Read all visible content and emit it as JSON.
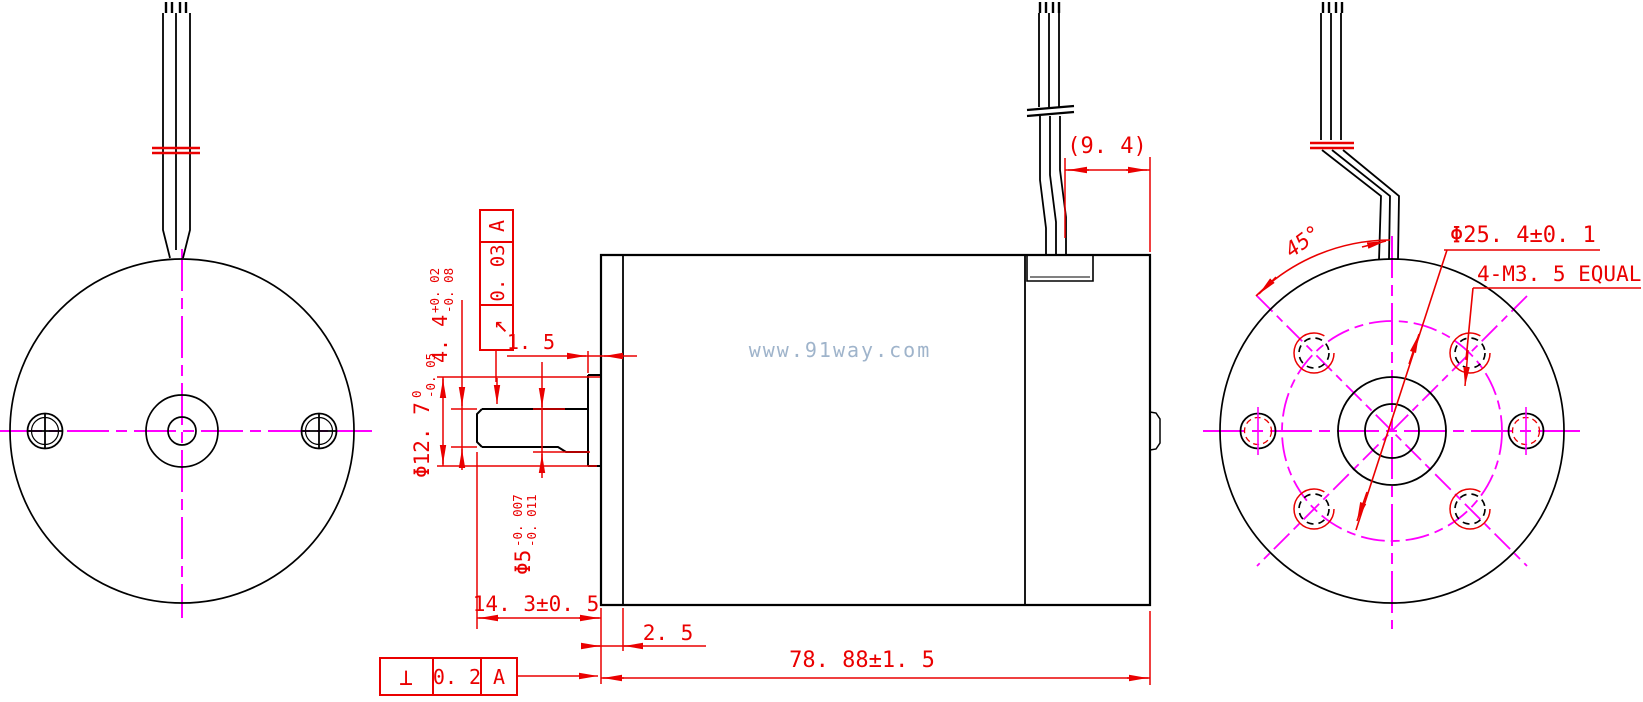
{
  "watermark": "www.91way.com",
  "colors": {
    "geometry": "#000000",
    "dimension": "#ea0000",
    "centerline": "#ff00ff",
    "watermark": "#8fa7c2"
  },
  "dimensions": {
    "wire_stub": "(9. 4)",
    "boss_protrusion": "1. 5",
    "shaft_flat": {
      "value": "4. 4",
      "upper": "+0. 02",
      "lower": "-0. 08"
    },
    "boss_diameter": {
      "value": "Φ12. 7",
      "upper": "0",
      "lower": "-0. 05"
    },
    "shaft_diameter": {
      "value": "Φ5",
      "upper": "-0. 007",
      "lower": "-0. 011"
    },
    "shaft_length": "14. 3±0. 5",
    "flange_width": "2. 5",
    "body_length": "78. 88±1. 5",
    "hole_angle": "45°",
    "bolt_circle_diameter": "Φ25. 4±0. 1",
    "mounting_holes": "4-M3. 5 EQUAL"
  },
  "gdt": {
    "runout": {
      "symbol": "↗",
      "tolerance": "0. 03",
      "datum": "A"
    },
    "perpendicularity": {
      "symbol": "⊥",
      "tolerance": "0. 2",
      "datum": "A"
    }
  }
}
